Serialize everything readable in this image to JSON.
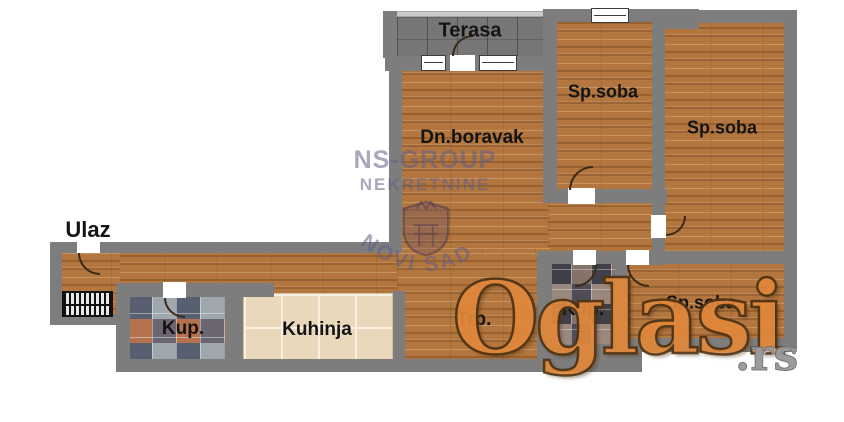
{
  "plan": {
    "rooms": {
      "terasa": "Terasa",
      "dn_boravak": "Dn.boravak",
      "sp_soba_top": "Sp.soba",
      "sp_soba_right": "Sp.soba",
      "sp_soba_bottom": "Sp.soba",
      "ulaz": "Ulaz",
      "kup_left": "Kup.",
      "kup_right": "Kup.",
      "kuhinja": "Kuhinja",
      "trpezarija": "Trp."
    }
  },
  "watermarks": {
    "agency_line1": "NS-GROUP",
    "agency_line2": "NEKRETNINE",
    "agency_arc": "NOVI SAD",
    "portal_name": "Oglasi",
    "portal_tld": ".rs"
  },
  "colors": {
    "wall_gray": "#7d7d7d",
    "wood_floor": "#b3763e",
    "terrace_tile": "#767676",
    "kitchen_tile": "#e9d8ba",
    "portal_orange": "#e0873b",
    "agency_slate": "#5f5f87"
  }
}
